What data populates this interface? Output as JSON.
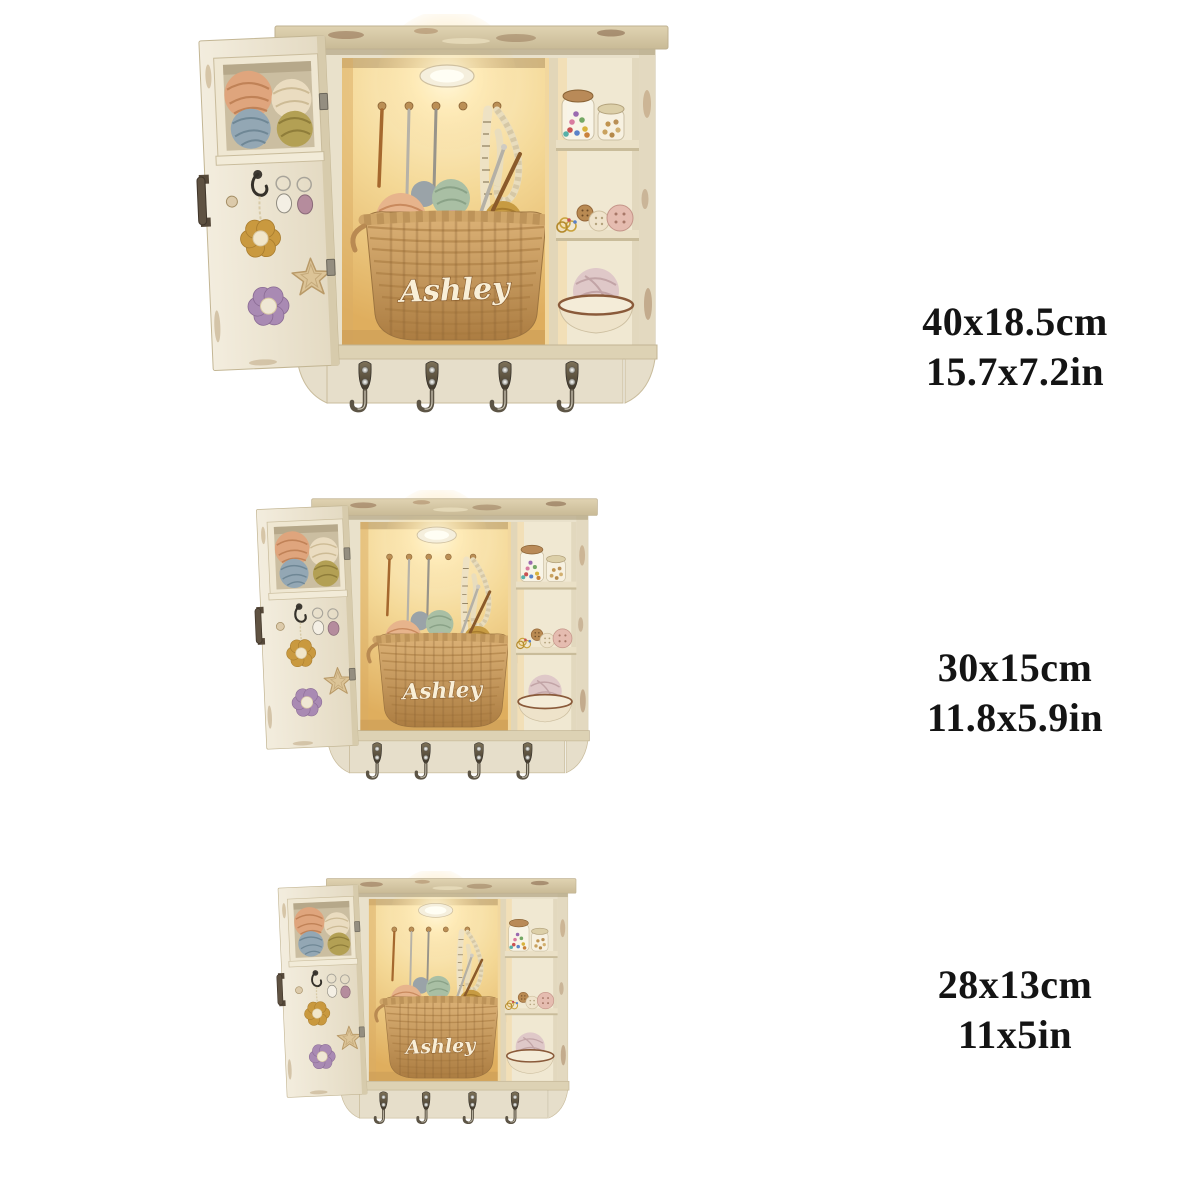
{
  "product": {
    "personalized_name": "Ashley"
  },
  "variants": [
    {
      "id": "size-40cm",
      "cm": "40x18.5cm",
      "in": "15.7x7.2in"
    },
    {
      "id": "size-30cm",
      "cm": "30x15cm",
      "in": "11.8x5.9in"
    },
    {
      "id": "size-28cm",
      "cm": "28x13cm",
      "in": "11x5in"
    }
  ],
  "colors": {
    "background": "#ffffff",
    "label_text": "#141414",
    "cabinet_cream": "#eae1cb",
    "interior_glow": "#f3d592",
    "basket_tan": "#c79a5e",
    "name_script": "#f9efd7"
  }
}
